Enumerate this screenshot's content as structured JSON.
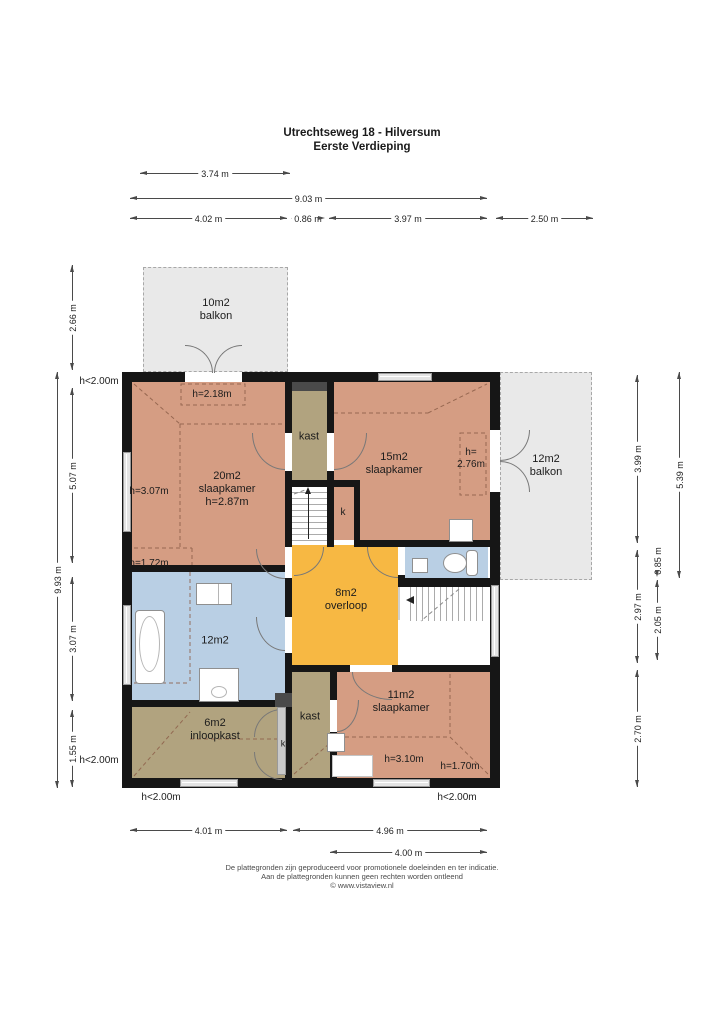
{
  "title": {
    "line1": "Utrechtseweg 18 - Hilversum",
    "line2": "Eerste Verdieping"
  },
  "dims": {
    "top_a": "3.74 m",
    "top_b": "9.03 m",
    "top_c1": "4.02 m",
    "top_c2": "0.86 m",
    "top_c3": "3.97 m",
    "top_c4": "2.50 m",
    "left_a": "2.66 m",
    "left_b": "5.07 m",
    "left_c": "9.93 m",
    "left_d": "3.07 m",
    "left_e": "1.55 m",
    "right_a": "3.99 m",
    "right_b": "2.97 m",
    "right_c": "2.70 m",
    "right_d": "0.85 m",
    "right_e": "2.05 m",
    "right_f": "5.39 m",
    "bottom_a": "4.01 m",
    "bottom_b": "4.96 m",
    "bottom_c": "4.00 m"
  },
  "height_notes": {
    "nw": "h<2.00m",
    "sw": "h<2.00m",
    "s1": "h<2.00m",
    "s2": "h<2.00m",
    "s20_door": "h=2.18m",
    "s20_left": "h=3.07m",
    "s20_low": "h=1.72m",
    "s15_line1": "h=",
    "s15_line2": "2.76m",
    "s11_a": "h=3.10m",
    "s11_b": "h=1.70m"
  },
  "rooms": {
    "balkon_tl": {
      "area": "10m2",
      "name": "balkon"
    },
    "balkon_r": {
      "area": "12m2",
      "name": "balkon"
    },
    "slaapkamer20": {
      "area": "20m2",
      "name": "slaapkamer",
      "height": "h=2.87m"
    },
    "slaapkamer15": {
      "area": "15m2",
      "name": "slaapkamer"
    },
    "slaapkamer11": {
      "area": "11m2",
      "name": "slaapkamer"
    },
    "overloop": {
      "area": "8m2",
      "name": "overloop"
    },
    "badkamer": {
      "area": "12m2"
    },
    "inloopkast": {
      "area": "6m2",
      "name": "inloopkast"
    },
    "kast_top": {
      "name": "kast"
    },
    "kast_bottom": {
      "name": "kast"
    },
    "k1": {
      "name": "k"
    },
    "k2": {
      "name": "k"
    }
  },
  "colors": {
    "bedroom": "#d59d83",
    "closet": "#b1a37f",
    "bath": "#b9cfe4",
    "hall": "#f7b843",
    "balcony": "#e9e9e9",
    "wall": "#161616"
  },
  "footer": {
    "line1": "De plattegronden zijn geproduceerd voor promotionele doeleinden en ter indicatie.",
    "line2": "Aan de plattegronden kunnen geen rechten worden ontleend",
    "line3": "© www.vistaview.nl"
  }
}
